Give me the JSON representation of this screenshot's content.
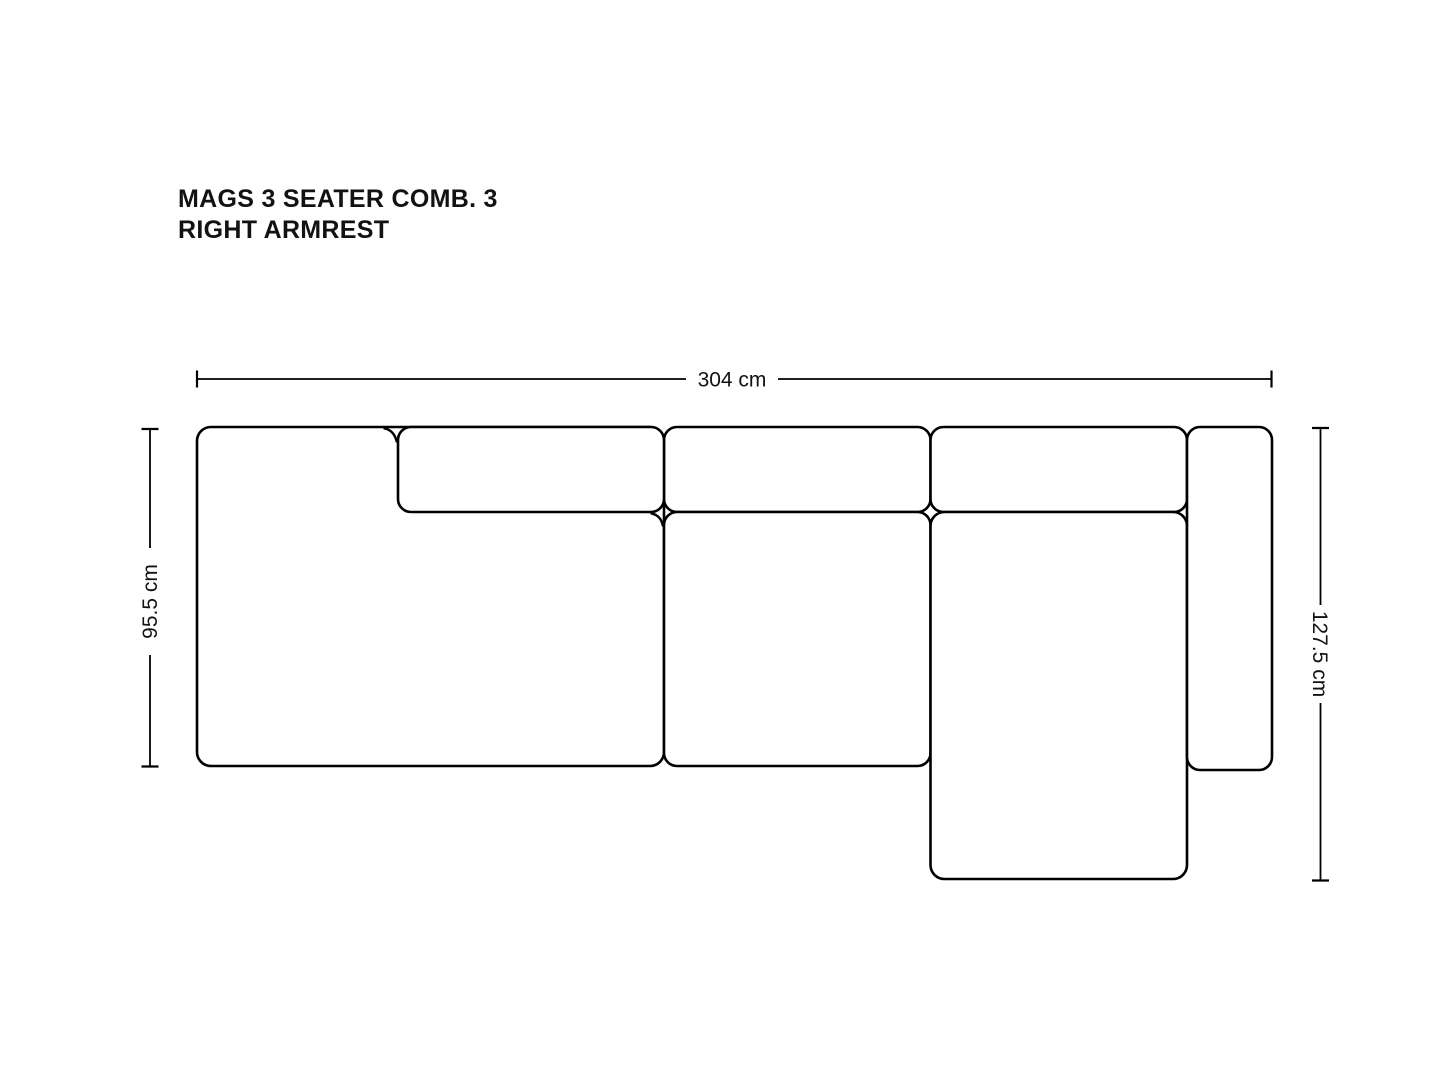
{
  "title": {
    "line1": "MAGS 3 SEATER COMB. 3",
    "line2": "RIGHT ARMREST"
  },
  "dimensions": {
    "width": {
      "label": "304 cm"
    },
    "height_left": {
      "label": "95.5 cm"
    },
    "height_right": {
      "label": "127.5 cm"
    }
  },
  "diagram": {
    "type": "sofa-top-view-technical-drawing",
    "modules": [
      "left-armrest-seat-module",
      "left-backrest-cushion",
      "middle-backrest-cushion",
      "middle-seat-module",
      "chaise-backrest-cushion",
      "chaise-lounge-seat",
      "right-armrest"
    ],
    "colors": {
      "outline": "#000000",
      "fill": "#ffffff"
    }
  }
}
